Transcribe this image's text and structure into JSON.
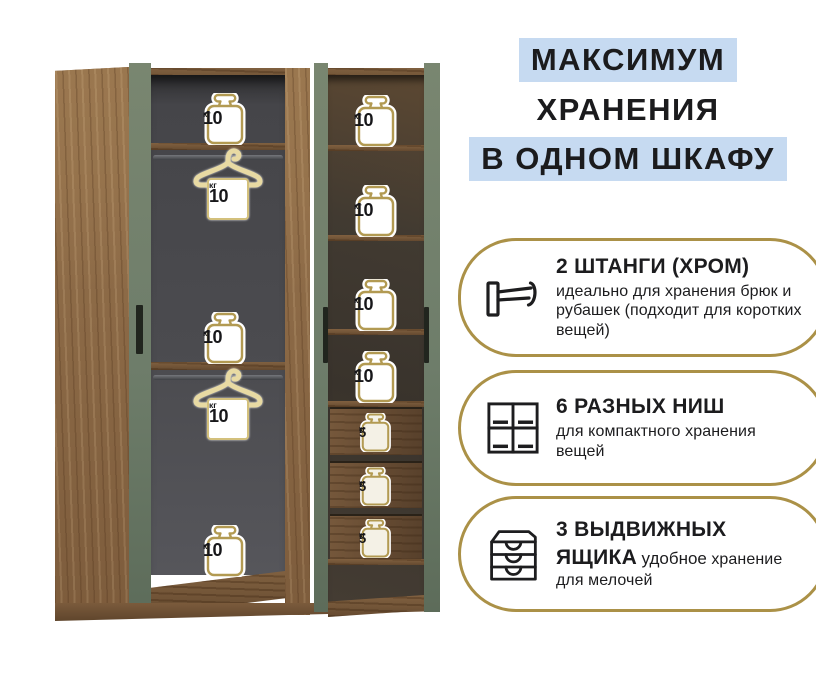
{
  "header": {
    "lines": [
      {
        "text": "МАКСИМУМ",
        "highlight": true
      },
      {
        "text": "ХРАНЕНИЯ",
        "highlight": false
      },
      {
        "text": "В ОДНОМ ШКАФУ",
        "highlight": true
      }
    ]
  },
  "features": [
    {
      "icon": "clothes-rail-icon",
      "title": "2 ШТАНГИ (ХРОМ)",
      "body": "идеально для хранения брюк и рубашек (подходит для коротких вещей)"
    },
    {
      "icon": "shelf-niches-icon",
      "title": "6 РАЗНЫХ НИШ",
      "body": "для компактного хранения вещей"
    },
    {
      "icon": "drawers-icon",
      "title": "3 ВЫДВИЖНЫХ ЯЩИКА",
      "title_suffix": "удобное",
      "body": "хранение для мелочей"
    }
  ],
  "wardrobe": {
    "left_badges": [
      {
        "kind": "weight",
        "value": "10",
        "unit": "кг"
      },
      {
        "kind": "hanger-weight",
        "value": "10",
        "unit": "кг"
      },
      {
        "kind": "weight",
        "value": "10",
        "unit": "кг"
      },
      {
        "kind": "hanger-weight",
        "value": "10",
        "unit": "кг"
      },
      {
        "kind": "weight",
        "value": "10",
        "unit": "кг"
      }
    ],
    "right_badges": [
      {
        "kind": "weight",
        "value": "10",
        "unit": "кг"
      },
      {
        "kind": "weight",
        "value": "10",
        "unit": "кг"
      },
      {
        "kind": "weight",
        "value": "10",
        "unit": "кг"
      },
      {
        "kind": "weight",
        "value": "10",
        "unit": "кг"
      },
      {
        "kind": "drawer-weight",
        "value": "5",
        "unit": "кг"
      },
      {
        "kind": "drawer-weight",
        "value": "5",
        "unit": "кг"
      },
      {
        "kind": "drawer-weight",
        "value": "5",
        "unit": "кг"
      }
    ]
  },
  "colors": {
    "highlight_blue": "#c6daf1",
    "accent_gold": "#ab9147",
    "badge_gold": "#b29a52",
    "door_green": "#6e7d6a",
    "wood": "#8a6a48",
    "interior_gray": "#4b4b4f",
    "text_dark": "#1c1c1e"
  }
}
